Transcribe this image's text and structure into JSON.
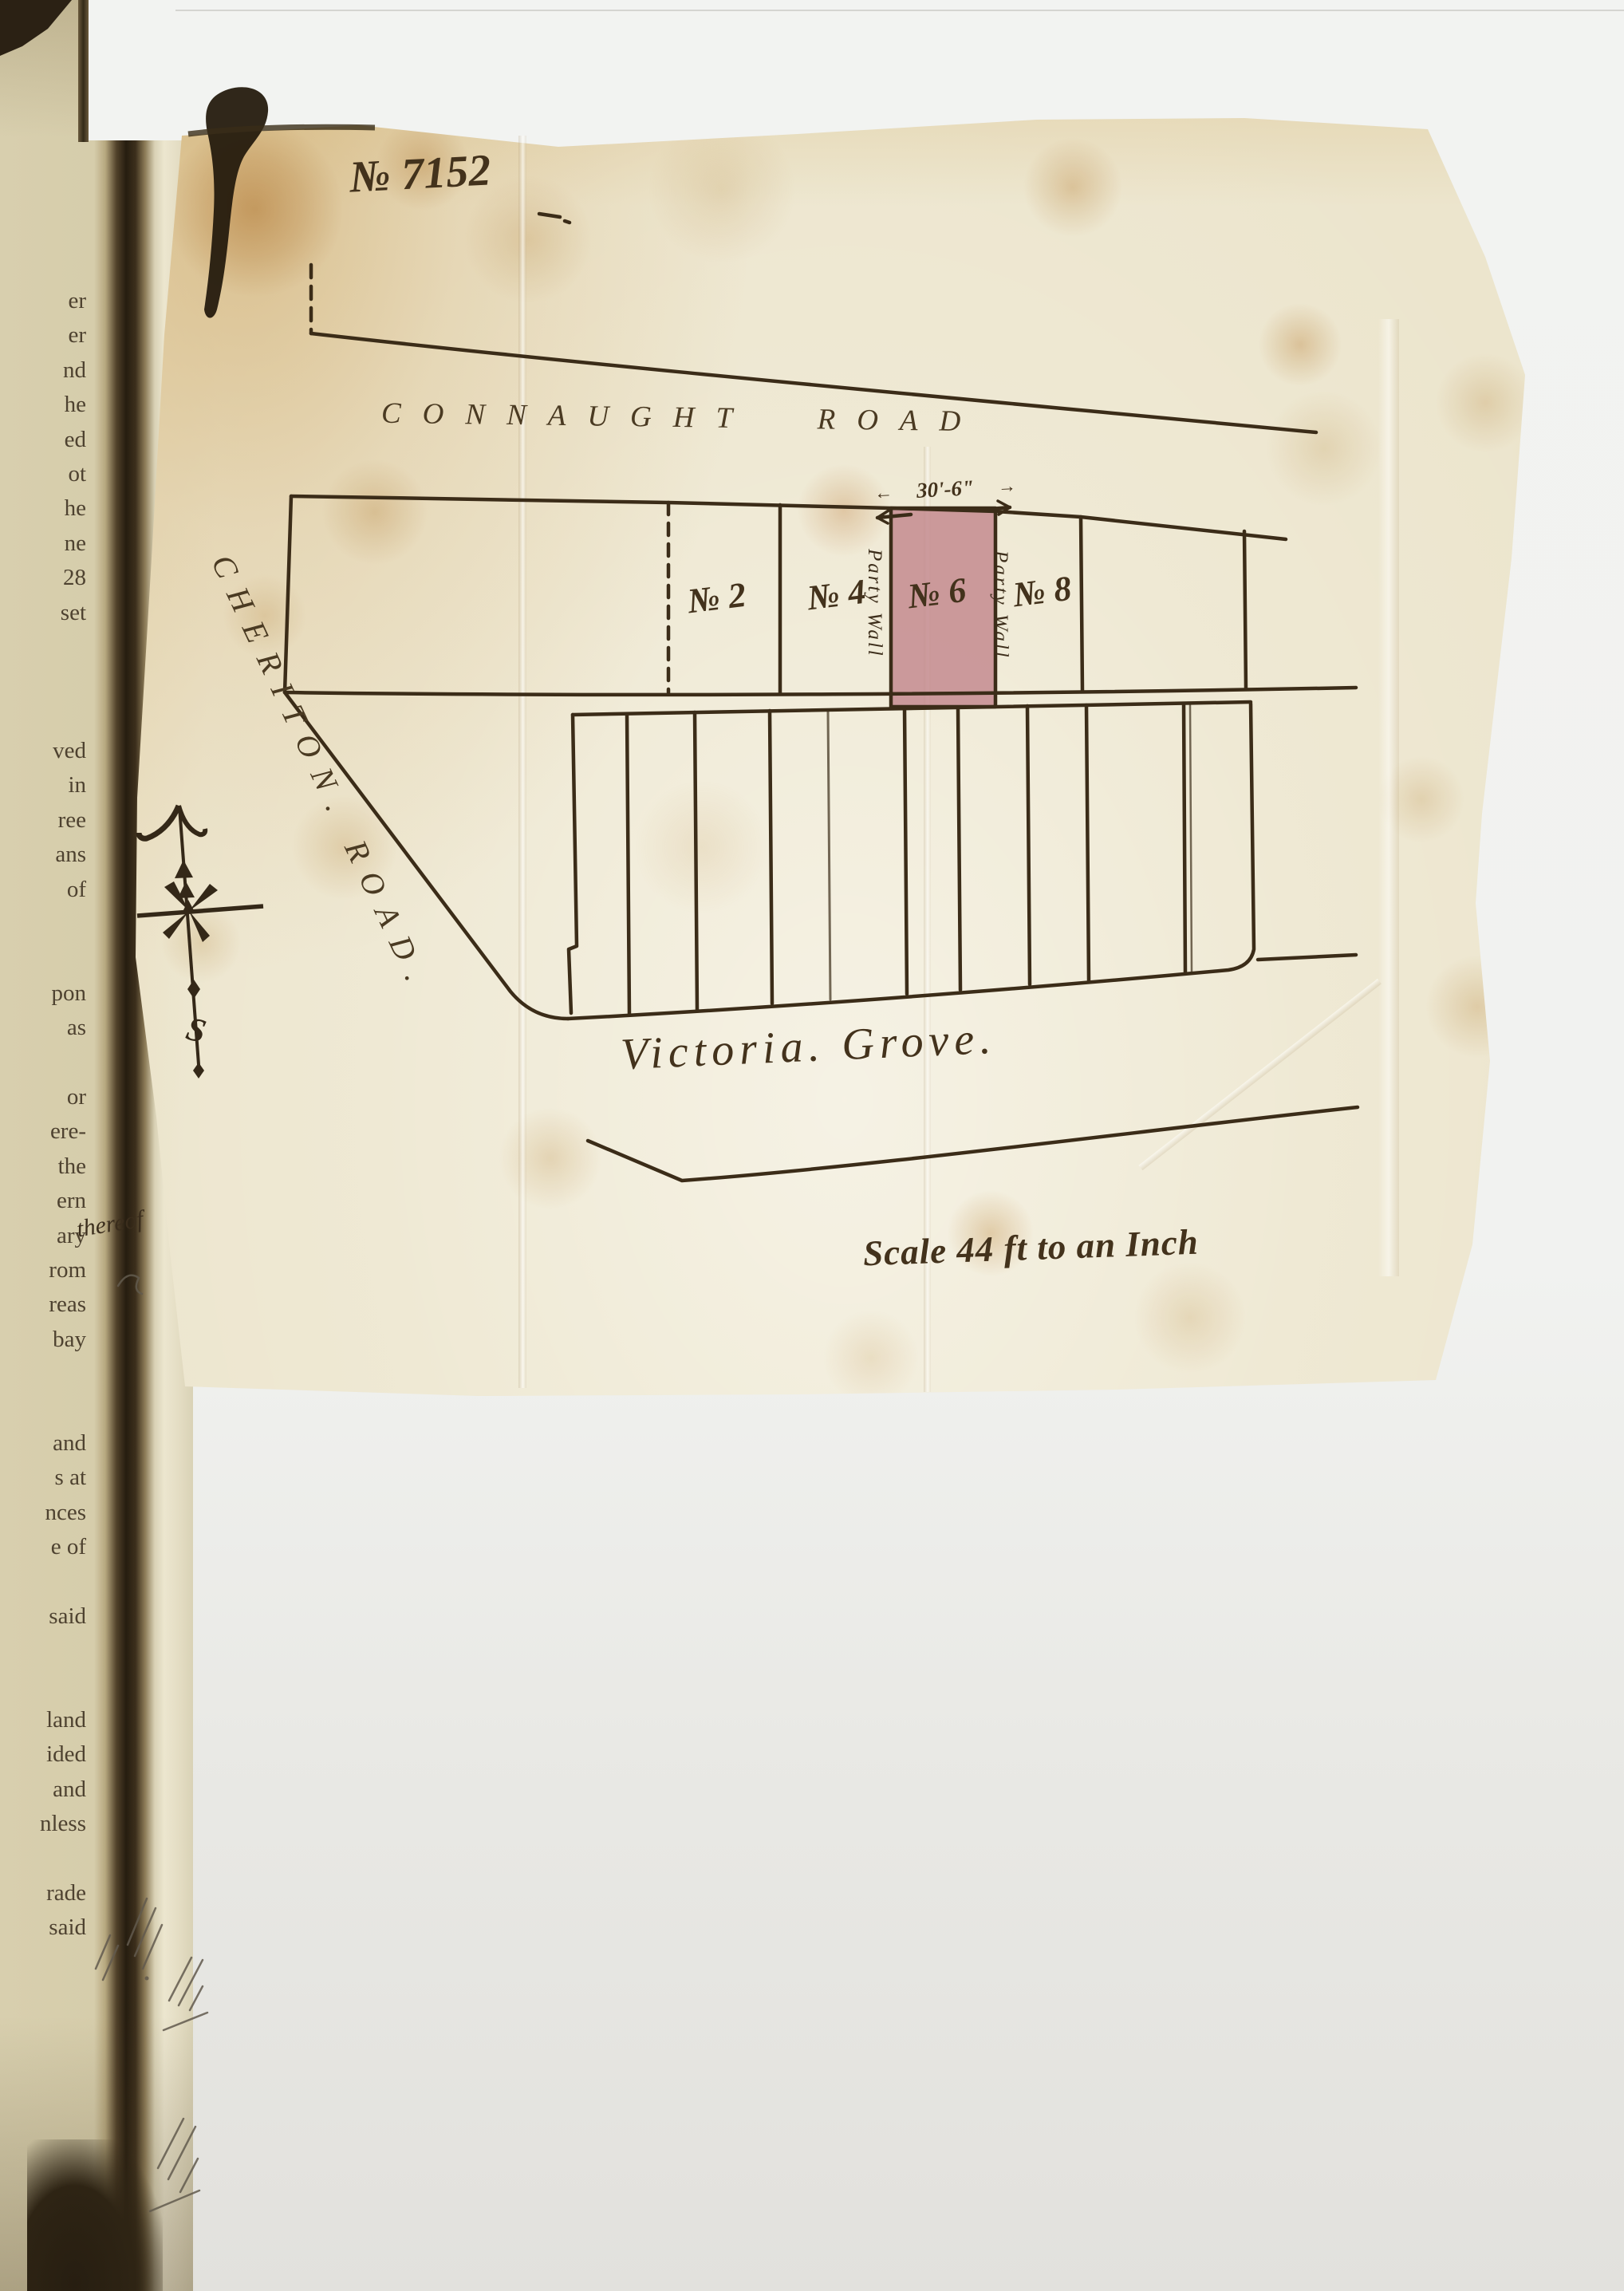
{
  "document": {
    "number": "№ 7152"
  },
  "plan": {
    "road_top": "CONNAUGHT ROAD",
    "road_left": "CHERITON. ROAD.",
    "road_bottom": "Victoria. Grove.",
    "plots": [
      {
        "label": "№ 2"
      },
      {
        "label": "№ 4"
      },
      {
        "label": "№ 6"
      },
      {
        "label": "№ 8"
      }
    ],
    "highlighted_plot": "№ 6",
    "highlight_color": "#c48b8f",
    "party_wall_labels": [
      "Party Wall",
      "Party Wall"
    ],
    "frontage_dimension": "30'-6\"",
    "scale_note": "Scale 44 ft to an Inch",
    "compass": {
      "south_label": "S"
    }
  },
  "icons": {
    "dimension_arrow_left": "←",
    "dimension_arrow_right": "→"
  },
  "left_page": {
    "fragments": [
      "er",
      "er",
      "nd",
      "he",
      "ed",
      "ot",
      "he",
      "ne",
      "28",
      "set",
      "",
      "",
      "",
      "ved",
      "in",
      "ree",
      "ans",
      "of",
      "",
      "",
      "pon",
      "as",
      "",
      "or",
      "ere-",
      "the",
      "ern",
      "ary",
      "rom",
      "reas",
      "bay",
      "",
      "",
      "and",
      "s at",
      "nces",
      "e of",
      "",
      "said",
      "",
      "",
      "land",
      "ided",
      "and",
      "nless",
      "",
      "rade",
      "said"
    ],
    "handwritten_note": "thereof"
  }
}
